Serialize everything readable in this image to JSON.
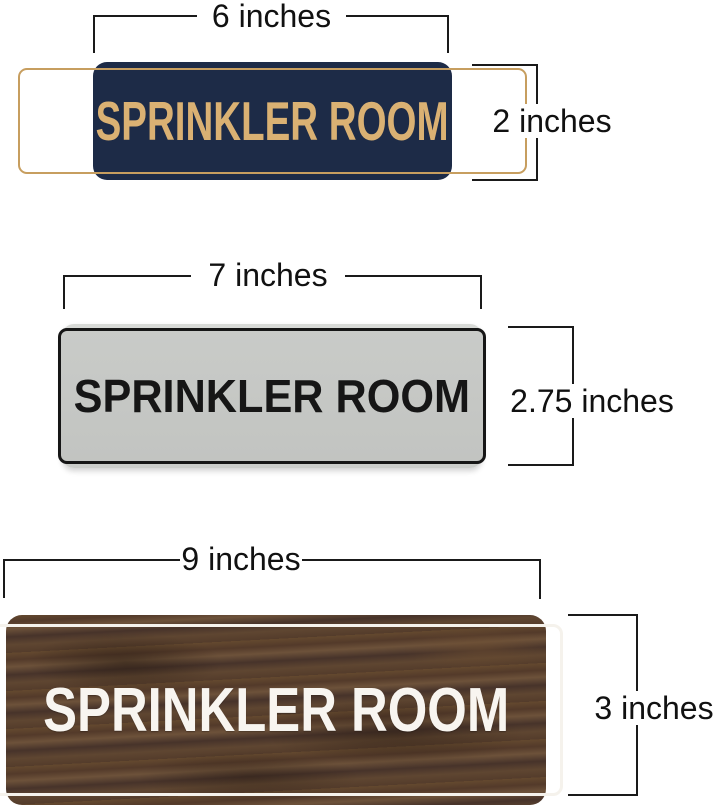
{
  "page": {
    "background": "#ffffff"
  },
  "signs": [
    {
      "name": "navy-gold-sign",
      "text": "SPRINKLER ROOM",
      "width_label": "6 inches",
      "height_label": "2 inches",
      "colors": {
        "background": "#1d2b47",
        "border": "#c79e5f",
        "text": "#dab173"
      }
    },
    {
      "name": "silver-black-sign",
      "text": "SPRINKLER ROOM",
      "width_label": "7 inches",
      "height_label": "2.75 inches",
      "colors": {
        "background": "#c6c8c5",
        "rim": "#d6d8d5",
        "border": "#161616",
        "text": "#161616"
      }
    },
    {
      "name": "walnut-wood-sign",
      "text": "SPRINKLER ROOM",
      "width_label": "9 inches",
      "height_label": "3 inches",
      "colors": {
        "background": "#5b4330",
        "border": "#f5f2ec",
        "text": "#f8f5f0"
      }
    }
  ],
  "annotation": {
    "line_color": "#1a1a1a"
  }
}
